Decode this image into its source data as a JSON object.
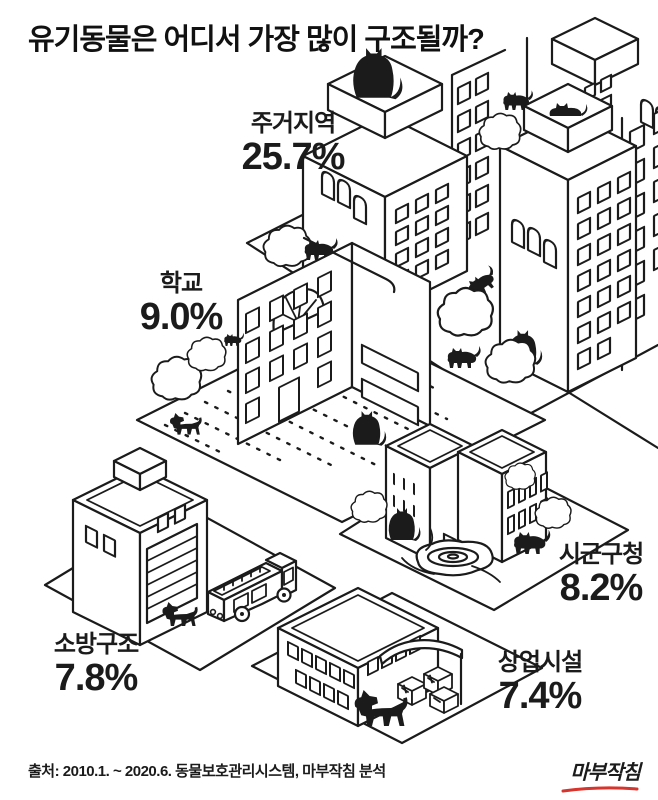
{
  "title": "유기동물은 어디서 가장 많이 구조될까?",
  "chart_data": {
    "type": "bar",
    "style": "isometric hand-drawn pictogram infographic (black line art city with cats and dogs)",
    "title": "유기동물은 어디서 가장 많이 구조될까?",
    "categories": [
      "주거지역",
      "학교",
      "시군구청",
      "소방구조",
      "상업시설"
    ],
    "values": [
      25.7,
      9.0,
      8.2,
      7.8,
      7.4
    ],
    "unit": "%",
    "grid": false,
    "legend_position": "none",
    "source": "출처: 2010.1. ~ 2020.6. 동물보호관리시스템, 마부작침 분석"
  },
  "labels": [
    {
      "id": "residential",
      "name": "주거지역",
      "value": "25.7%"
    },
    {
      "id": "school",
      "name": "학교",
      "value": "9.0%"
    },
    {
      "id": "district-office",
      "name": "시군구청",
      "value": "8.2%"
    },
    {
      "id": "fire-rescue",
      "name": "소방구조",
      "value": "7.8%"
    },
    {
      "id": "commercial",
      "name": "상업시설",
      "value": "7.4%"
    }
  ],
  "footer": {
    "source": "출처: 2010.1. ~ 2020.6. 동물보호관리시스템, 마부작침 분석",
    "logo": "마부작침"
  },
  "icons": [
    "cat-icon",
    "dog-icon",
    "tree-icon",
    "fire-truck-icon",
    "fountain-icon",
    "apartment-icon",
    "school-icon",
    "awning-icon"
  ],
  "colors": {
    "ink": "#1b1b1b",
    "background": "#ffffff",
    "logo_red": "#d6342c"
  }
}
